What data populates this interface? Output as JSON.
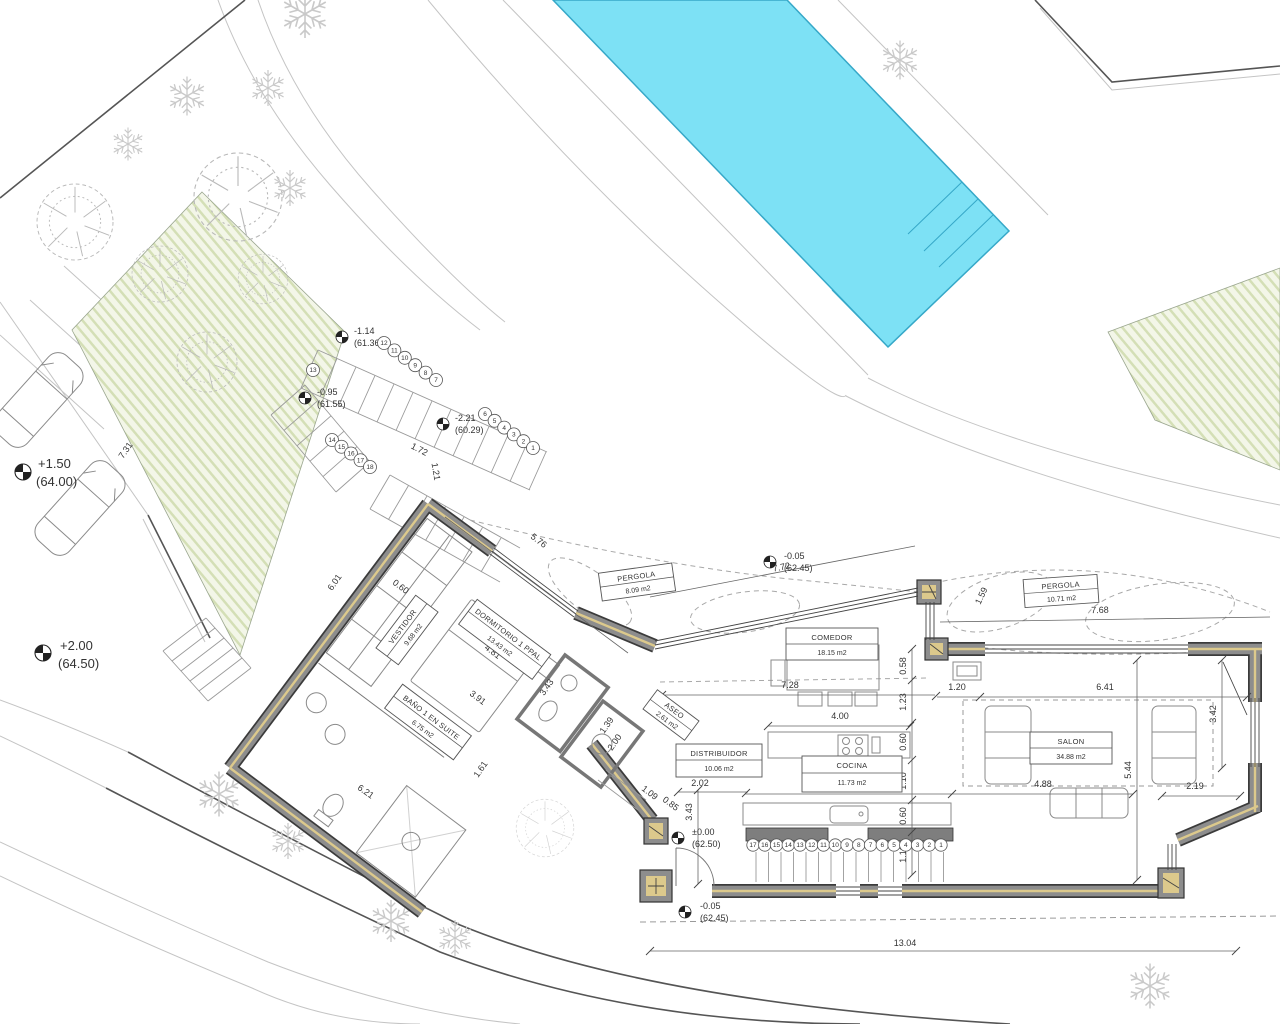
{
  "colors": {
    "pool_fill": "#7de1f5",
    "pool_border": "#36a8c8",
    "wall_gray": "#8d8d8d",
    "wall_liner": "#dcc98c",
    "garden_base": "#f3f6e8",
    "garden_stripe": "#d4dfb6"
  },
  "rooms": {
    "vestidor": {
      "name": "VESTIDOR",
      "area": "9.68 m2"
    },
    "dormitorio": {
      "name": "DORMITORIO 1 PPAL",
      "area": "13.43 m2"
    },
    "bano": {
      "name": "BAÑO 1 EN SUITE",
      "area": "6.75 m2"
    },
    "aseo": {
      "name": "ASEO",
      "area": "2.61 m2"
    },
    "distribuidor": {
      "name": "DISTRIBUIDOR",
      "area": "10.06 m2"
    },
    "cocina": {
      "name": "COCINA",
      "area": "11.73 m2"
    },
    "comedor": {
      "name": "COMEDOR",
      "area": "18.15 m2"
    },
    "salon": {
      "name": "SALON",
      "area": "34.88 m2"
    },
    "pergola1": {
      "name": "PERGOLA",
      "area": "8.09 m2"
    },
    "pergola2": {
      "name": "PERGOLA",
      "area": "10.71 m2"
    }
  },
  "levels": {
    "e1": {
      "value": "+1.50",
      "datum": "(64.00)"
    },
    "e2": {
      "value": "+2.00",
      "datum": "(64.50)"
    },
    "e3": {
      "value": "-1.14",
      "datum": "(61.36)"
    },
    "e4": {
      "value": "-0.95",
      "datum": "(61.55)"
    },
    "e5": {
      "value": "-2.21",
      "datum": "(60.29)"
    },
    "e6": {
      "value": "-0.05",
      "datum": "(62.45)"
    },
    "e7": {
      "value": "±0.00",
      "datum": "(62.50)"
    },
    "e8": {
      "value": "-0.05",
      "datum": "(62.45)"
    }
  },
  "dims": {
    "d576": "5.76",
    "d772": "7.72",
    "d768": "7.68",
    "d060a": "0.60",
    "d481": "4.81",
    "d391": "3.91",
    "d343a": "3.43",
    "d161": "1.61",
    "d601": "6.01",
    "d621": "6.21",
    "d731": "7.31",
    "d172": "1.72",
    "d121": "1.21",
    "d139": "1.39",
    "d200": "2.00",
    "d109": "1.09",
    "d085": "0.85",
    "d202": "2.02",
    "d343b": "3.43",
    "d728": "7.28",
    "d120": "1.20",
    "d641": "6.41",
    "d058": "0.58",
    "d123": "1.23",
    "d060b": "0.60",
    "d110a": "1.10",
    "d060c": "0.60",
    "d110b": "1.10",
    "d400": "4.00",
    "d510": "5.10",
    "d488": "4.88",
    "d219": "2.19",
    "d342": "3.42",
    "d544": "5.44",
    "d1304": "13.04",
    "d159": "1.59"
  },
  "stairs": {
    "upper": [
      "12",
      "11",
      "10",
      "9",
      "8",
      "7"
    ],
    "mid": [
      "6",
      "5",
      "4",
      "3",
      "2",
      "1"
    ],
    "left13": [
      "13"
    ],
    "left": [
      "14",
      "15",
      "16",
      "17",
      "18"
    ],
    "terrace": [
      "17",
      "16",
      "15",
      "14",
      "13",
      "12",
      "11",
      "10",
      "9",
      "8",
      "7",
      "6",
      "5",
      "4",
      "3",
      "2",
      "1"
    ]
  }
}
